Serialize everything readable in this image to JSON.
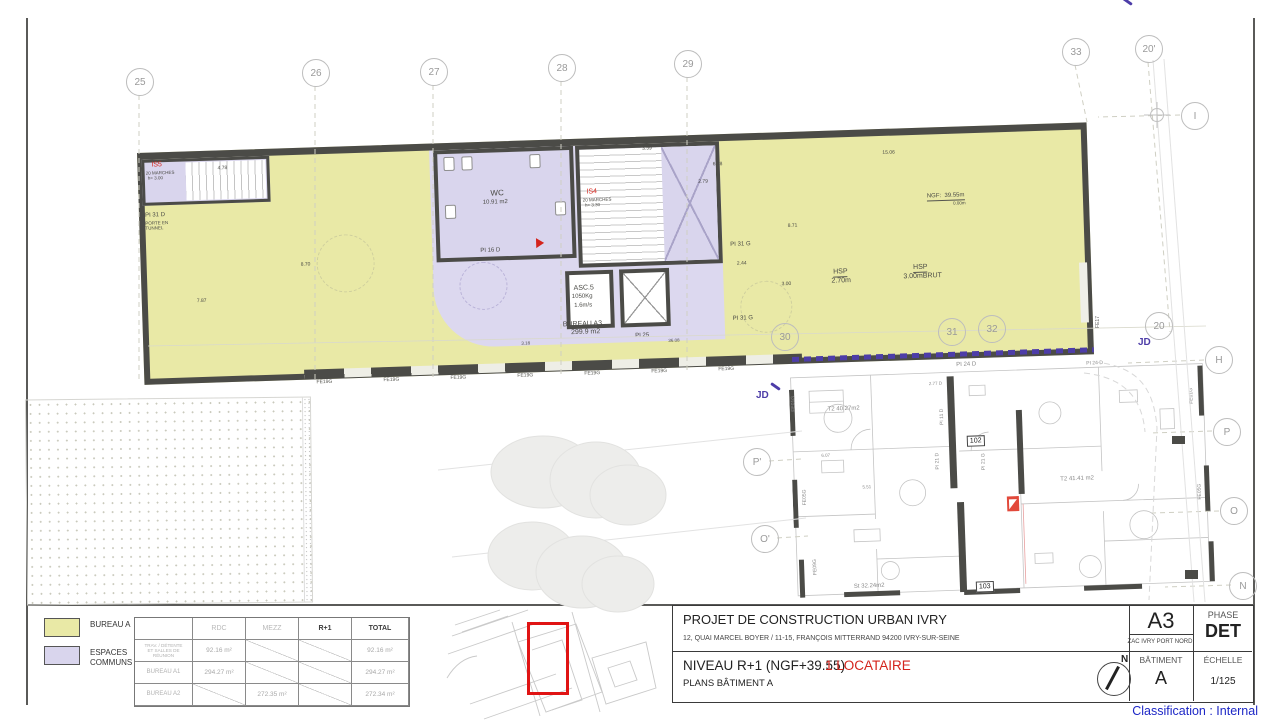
{
  "classification": "Classification : Internal",
  "title_block": {
    "project_title": "PROJET DE CONSTRUCTION URBAN IVRY",
    "address": "12, QUAI MARCEL BOYER  / 11-15, FRANÇOIS MITTERRAND   94200 IVRY-SUR-SEINE",
    "zac": "ZAC IVRY PORT NORD",
    "sheet_code": "A3",
    "phase_label": "PHASE",
    "phase_value": "DET",
    "level_title": "NIVEAU R+1 (NGF+39.55)",
    "tenant_note": "1 LOCATAIRE",
    "plan_subtitle": "PLANS BÂTIMENT A",
    "north_label": "N",
    "batiment_label": "BÂTIMENT",
    "batiment_value": "A",
    "echelle_label": "ÉCHELLE",
    "echelle_value": "1/125"
  },
  "legend": {
    "items": [
      {
        "label": "BUREAU A",
        "color": "#e9e9a6"
      },
      {
        "label": "ESPACES\nCOMMUNS",
        "color": "#d9d5ed"
      }
    ],
    "table": {
      "headers": [
        "",
        "RDC",
        "MEZZ",
        "R+1",
        "TOTAL"
      ],
      "rows": [
        {
          "label": "TRAV. / DÉTENTE\nET SALLES DE\nRÉUNION",
          "small": true,
          "cells": [
            {
              "text": "92.16 m²"
            },
            {
              "diag": true
            },
            {
              "diag": true
            },
            {
              "text": "92.16 m²"
            }
          ]
        },
        {
          "label": "BUREAU A1",
          "cells": [
            {
              "text": "294.27 m²"
            },
            {
              "diag": true
            },
            {
              "diag": true
            },
            {
              "text": "294.27 m²"
            }
          ]
        },
        {
          "label": "BUREAU A2",
          "cells": [
            {
              "diag": true
            },
            {
              "text": "272.35 m²"
            },
            {
              "diag": true
            },
            {
              "text": "272.34 m²"
            }
          ]
        }
      ]
    }
  },
  "grid_bubbles": [
    {
      "label": "25",
      "x": 139,
      "y": 81
    },
    {
      "label": "26",
      "x": 315,
      "y": 72
    },
    {
      "label": "27",
      "x": 433,
      "y": 71
    },
    {
      "label": "28",
      "x": 561,
      "y": 67
    },
    {
      "label": "29",
      "x": 687,
      "y": 63
    },
    {
      "label": "30",
      "x": 784,
      "y": 336
    },
    {
      "label": "31",
      "x": 951,
      "y": 331
    },
    {
      "label": "32",
      "x": 991,
      "y": 328
    },
    {
      "label": "33",
      "x": 1075,
      "y": 51
    },
    {
      "label": "20'",
      "x": 1148,
      "y": 48
    },
    {
      "label": "I",
      "x": 1194,
      "y": 115
    },
    {
      "label": "20",
      "x": 1158,
      "y": 325
    },
    {
      "label": "H",
      "x": 1218,
      "y": 359
    },
    {
      "label": "P",
      "x": 1226,
      "y": 431
    },
    {
      "label": "P'",
      "x": 756,
      "y": 461
    },
    {
      "label": "O",
      "x": 1233,
      "y": 510
    },
    {
      "label": "O'",
      "x": 764,
      "y": 538
    },
    {
      "label": "N",
      "x": 1242,
      "y": 585
    }
  ],
  "plan": {
    "window_label": "FE19G",
    "window_count": 7,
    "right_window_label": "FE17",
    "jd_label": "JD",
    "colors": {
      "bureau": "#e9e9a6",
      "communs": "#d9d5ed",
      "wall": "#4b4b47",
      "jd": "#4d3da8",
      "red": "#d4241c"
    },
    "building_labels": [
      {
        "t": "IS5",
        "x": 14,
        "y": 9,
        "fs": 7,
        "c": "red"
      },
      {
        "t": "20 MARCHES",
        "x": 8,
        "y": 18,
        "fs": 4.5
      },
      {
        "t": "h= 3.00",
        "x": 10,
        "y": 23,
        "fs": 4.5
      },
      {
        "t": "4.78",
        "x": 80,
        "y": 16,
        "fs": 5
      },
      {
        "t": "PI 31 D",
        "x": 6,
        "y": 60,
        "fs": 6
      },
      {
        "t": "PORTE EN\nTUNNEL",
        "x": 6,
        "y": 68,
        "fs": 4.5
      },
      {
        "t": "7.87",
        "x": 55,
        "y": 148,
        "fs": 5
      },
      {
        "t": "8.70",
        "x": 160,
        "y": 115,
        "fs": 5
      },
      {
        "t": "6.78",
        "x": 575,
        "y": 28,
        "fs": 5
      },
      {
        "t": "15.06",
        "x": 745,
        "y": 22,
        "fs": 5
      },
      {
        "t": "WC",
        "x": 352,
        "y": 48,
        "fs": 8
      },
      {
        "t": "10.91 m2",
        "x": 344,
        "y": 58,
        "fs": 6
      },
      {
        "t": "PI 16 D",
        "x": 340,
        "y": 106,
        "fs": 6
      },
      {
        "t": "IS4",
        "x": 448,
        "y": 50,
        "fs": 7,
        "c": "red"
      },
      {
        "t": "20 MARCHES",
        "x": 444,
        "y": 59,
        "fs": 4.5
      },
      {
        "t": "h= 3.30",
        "x": 446,
        "y": 64,
        "fs": 4.5
      },
      {
        "t": "3.59",
        "x": 505,
        "y": 10,
        "fs": 5
      },
      {
        "t": "2.79",
        "x": 560,
        "y": 45,
        "fs": 5
      },
      {
        "t": "ASC.5",
        "x": 432,
        "y": 146,
        "fs": 7
      },
      {
        "t": "1050Kg",
        "x": 430,
        "y": 155,
        "fs": 6
      },
      {
        "t": "1.6m/s",
        "x": 432,
        "y": 164,
        "fs": 6
      },
      {
        "t": "PI 25",
        "x": 492,
        "y": 196,
        "fs": 6
      },
      {
        "t": "PI 31 G",
        "x": 590,
        "y": 108,
        "fs": 6
      },
      {
        "t": "2.44",
        "x": 596,
        "y": 128,
        "fs": 5
      },
      {
        "t": "PI 31 G",
        "x": 590,
        "y": 182,
        "fs": 6
      },
      {
        "t": "3.00",
        "x": 640,
        "y": 150,
        "fs": 5
      },
      {
        "t": "8.71",
        "x": 648,
        "y": 92,
        "fs": 5
      },
      {
        "t": "HSP",
        "x": 692,
        "y": 138,
        "fs": 7,
        "c": "u"
      },
      {
        "t": "2.70m",
        "x": 690,
        "y": 147,
        "fs": 7
      },
      {
        "t": "HSP",
        "x": 772,
        "y": 136,
        "fs": 7,
        "c": "u"
      },
      {
        "t": "3.00mBRUT",
        "x": 762,
        "y": 145,
        "fs": 7
      },
      {
        "t": "NGF:  39.55m",
        "x": 788,
        "y": 66,
        "fs": 6,
        "c": "u"
      },
      {
        "t": "0.00m",
        "x": 814,
        "y": 74,
        "fs": 4.5
      },
      {
        "t": "BUREAU A3",
        "x": 420,
        "y": 182,
        "fs": 7
      },
      {
        "t": "299.9 m2",
        "x": 428,
        "y": 190,
        "fs": 7
      },
      {
        "t": "3.18",
        "x": 378,
        "y": 200,
        "fs": 4.5
      },
      {
        "t": "36.08",
        "x": 525,
        "y": 202,
        "fs": 4.5
      }
    ],
    "apartment_labels": [
      {
        "t": "PI 24 D",
        "x": 168,
        "y": 6,
        "fs": 6
      },
      {
        "t": "PI 24 D",
        "x": 298,
        "y": 10,
        "fs": 5
      },
      {
        "t": "2.77 D",
        "x": 140,
        "y": 24,
        "fs": 4.5
      },
      {
        "t": "T2 40.27m2",
        "x": 38,
        "y": 46,
        "fs": 6
      },
      {
        "t": "6.07",
        "x": 30,
        "y": 92,
        "fs": 4.5
      },
      {
        "t": "PI 11 D",
        "x": 150,
        "y": 52,
        "fs": 5,
        "v": true
      },
      {
        "t": "102",
        "x": 176,
        "y": 80,
        "fs": 7,
        "box": true
      },
      {
        "t": "PI 21 D",
        "x": 144,
        "y": 96,
        "fs": 5,
        "v": true
      },
      {
        "t": "PI 21 G",
        "x": 190,
        "y": 98,
        "fs": 5,
        "v": true
      },
      {
        "t": "5.51",
        "x": 70,
        "y": 125,
        "fs": 4.5
      },
      {
        "t": "T2 41.41 m2",
        "x": 268,
        "y": 124,
        "fs": 6
      },
      {
        "t": "St 32.24m2",
        "x": 58,
        "y": 224,
        "fs": 6
      },
      {
        "t": "103",
        "x": 180,
        "y": 226,
        "fs": 7,
        "box": true
      },
      {
        "t": "FE01G",
        "x": 2,
        "y": 34,
        "fs": 5,
        "v": true
      },
      {
        "t": "FE05G",
        "x": 10,
        "y": 128,
        "fs": 5,
        "v": true
      },
      {
        "t": "FE09G",
        "x": 18,
        "y": 198,
        "fs": 5,
        "v": true
      },
      {
        "t": "FE01G",
        "x": 400,
        "y": 40,
        "fs": 5,
        "v": true
      },
      {
        "t": "FE05G",
        "x": 405,
        "y": 136,
        "fs": 5,
        "v": true
      }
    ]
  }
}
